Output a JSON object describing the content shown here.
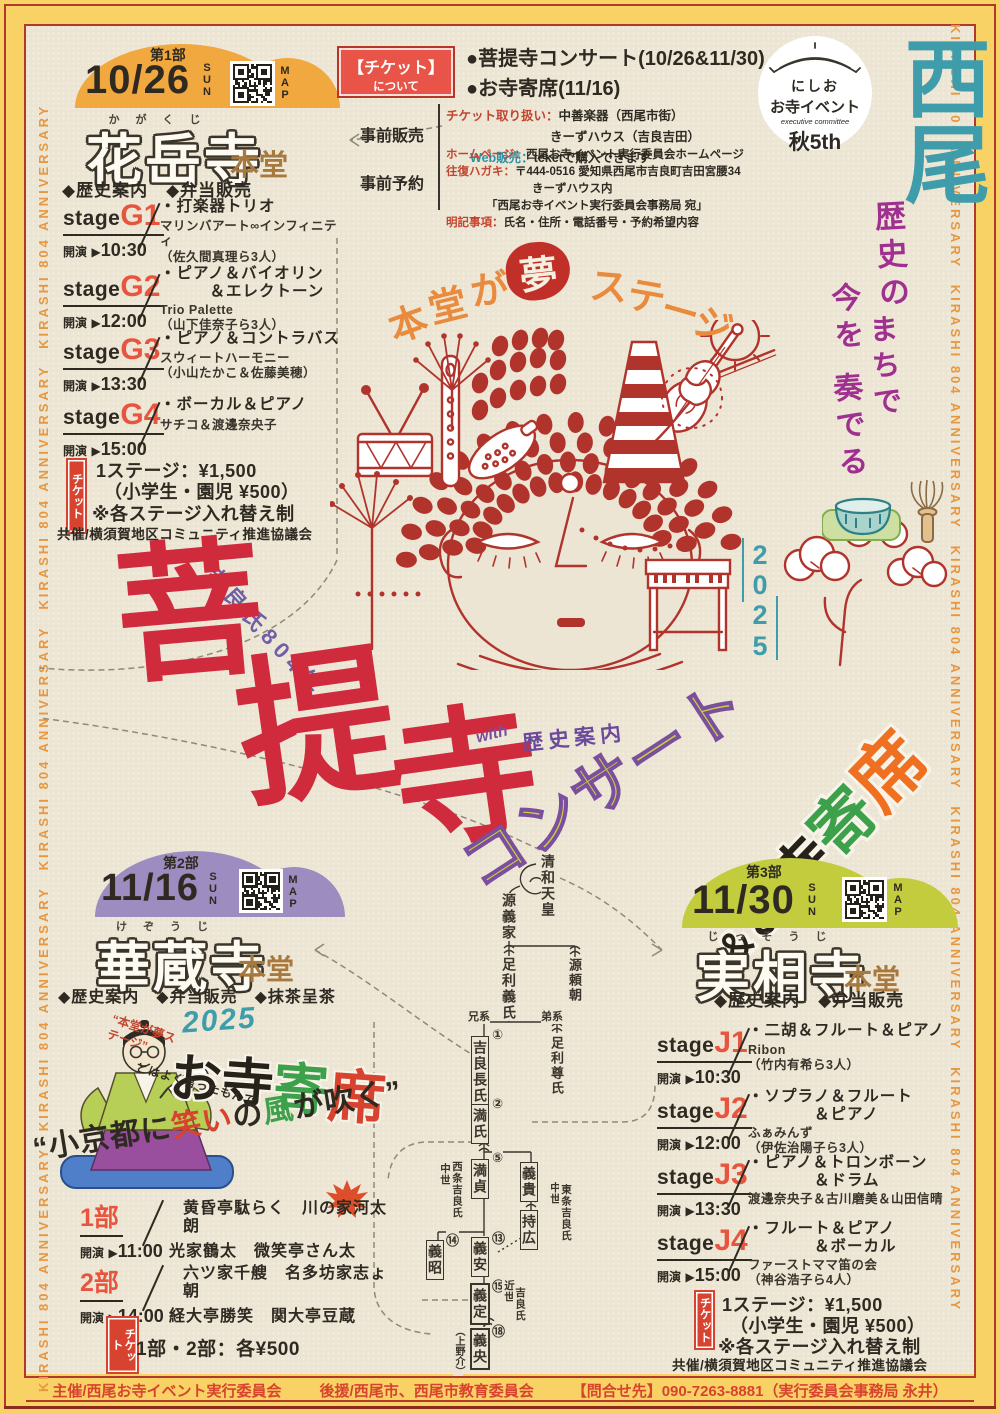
{
  "palette": {
    "bg_cream": "#ece5d3",
    "frame_yellow": "#f8d264",
    "frame_red": "#b0392b",
    "dome1_orange": "#f0a83f",
    "dome2_purple": "#9d8cc0",
    "dome3_yellowgreen": "#c3cc3d",
    "accent_red": "#d8432f",
    "art_red": "#b0342c",
    "teal": "#3f9dab",
    "purple": "#a0308f",
    "title_red": "#cf2b3c",
    "concert_green": "#c5d23e",
    "green": "#3da04b",
    "orange": "#ef7020",
    "brown": "#a8793f",
    "text_dark": "#2e2a22"
  },
  "frame": {
    "side_text": "KIRASHI 804 ANNIVERSARY　KIRASHI 804 ANNIVERSARY　KIRASHI 804 ANNIVERSARY　KIRASHI 804 ANNIVERSARY　KIRASHI 804 ANNIVERSARY"
  },
  "stages_common": {
    "stage": "stage",
    "kaien": "開演",
    "arrow": "▶"
  },
  "ticket_box": {
    "badge_title": "【チケット】",
    "badge_sub": "について",
    "item1": "●菩提寺コンサート(10/26&11/30)",
    "item2": "●お寺寄席(11/16)",
    "presale_label": "事前販売",
    "presale_l1_label": "チケット取り扱い：",
    "presale_l1": "中善楽器（西尾市街）",
    "presale_l2": "きーずハウス（吉良吉田）",
    "presale_l3_label": "Web販売：",
    "presale_l3": "teketで購入できます",
    "reserve_label": "事前予約",
    "reserve_l1_label": "ホームページ：",
    "reserve_l1": "西尾お寺イベント実行委員会ホームページ",
    "reserve_l2_label": "往復ハガキ：",
    "reserve_l2": "〒444-0516 愛知県西尾市吉良町吉田宮腰34",
    "reserve_l3": "きーずハウス内",
    "reserve_l4": "「西尾お寺イベント実行委員会事務局 宛」",
    "reserve_l5_label": "明記事項：",
    "reserve_l5": "氏名・住所・電話番号・予約希望内容"
  },
  "logo": {
    "line1": "にしお",
    "line2": "お寺イベント",
    "line3": "executive committee",
    "line4": "秋5th"
  },
  "nishio": {
    "chars": "西尾"
  },
  "tagline": {
    "c1": "歴史の",
    "c2": "まちで",
    "c3": "今を",
    "c4": "奏でる"
  },
  "dream": {
    "c0": "本",
    "c1": "堂",
    "c2": "が",
    "c3": "夢",
    "c4": "ス",
    "c5": "テ",
    "c6": "ー",
    "c7": "ジ"
  },
  "title": {
    "year": "吉良氏804年",
    "k1": "菩",
    "k2": "提",
    "k3": "寺",
    "with": "with",
    "guide": "歴史案内",
    "concert": "コンサート",
    "y0": "2",
    "y1": "0",
    "y2": "2",
    "y3": "5",
    "amp": "＆",
    "a1": "お",
    "a2": "寺",
    "a3": "寄",
    "a4": "席"
  },
  "part1": {
    "part": "第1部",
    "date": "10/26",
    "day": "SUN",
    "map": "MAP",
    "furigana": "かがくじ",
    "temple": "花岳寺",
    "hall": "本堂",
    "features": "◆歴史案内　◆弁当販売",
    "stages": [
      {
        "no": "G1",
        "time": "10:30",
        "p1": "・打楽器トリオ",
        "p2": "",
        "g1": "マリンバアート∞インフィニティ",
        "g2": "（佐久間真理ら3人）"
      },
      {
        "no": "G2",
        "time": "12:00",
        "p1": "・ピアノ＆バイオリン",
        "p2": "　　　＆エレクトーン",
        "g1": "Trio Palette",
        "g2": "（山下佳奈子ら3人）"
      },
      {
        "no": "G3",
        "time": "13:30",
        "p1": "・ピアノ＆コントラバス",
        "p2": "",
        "g1": "スウィートハーモニー",
        "g2": "（小山たかこ＆佐藤美穂）"
      },
      {
        "no": "G4",
        "time": "15:00",
        "p1": "・ボーカル＆ピアノ",
        "p2": "",
        "g1": "サチコ＆渡邊奈央子",
        "g2": ""
      }
    ],
    "ticket_badge": "チケット",
    "ticket1": "1ステージ：¥1,500",
    "ticket2": "（小学生・園児 ¥500）",
    "ticket3": "※各ステージ入れ替え制",
    "cosponsor": "共催/横須賀地区コミュニティ推進協議会"
  },
  "part2": {
    "part": "第2部",
    "date": "11/16",
    "day": "SUN",
    "map": "MAP",
    "furigana": "けぞうじ",
    "temple": "華蔵寺",
    "hall": "本堂",
    "features": "◆歴史案内　◆弁当販売　◆抹茶呈茶",
    "quote": "“本堂が夢ステージ”",
    "year": "2025",
    "yose1": "お寺",
    "yose2": "寄",
    "yose3": "席",
    "sub": "とはよく言ったもんで",
    "catch_a": "“小京都に",
    "catch_b": "笑い",
    "catch_c": "の",
    "catch_d": "風",
    "catch_e": "が吹く”",
    "programs": [
      {
        "no": "1部",
        "time": "11:00",
        "l1": "黄昏亭駄らく　川の家河太朗",
        "l2": "光家鶴太　微笑亭さん太"
      },
      {
        "no": "2部",
        "time": "14:00",
        "l1": "六ツ家千艘　名多坊家志ょ朝",
        "l2": "経大亭勝笑　関大亭豆蔵"
      }
    ],
    "ticket_badge": "チケット",
    "ticket": "1部・2部：各¥500"
  },
  "part3": {
    "part": "第3部",
    "date": "11/30",
    "day": "SUN",
    "map": "MAP",
    "furigana": "じっそうじ",
    "temple": "実相寺",
    "hall": "本堂",
    "features": "◆歴史案内　◆弁当販売",
    "stages": [
      {
        "no": "J1",
        "time": "10:30",
        "p1": "・二胡＆フルート＆ピアノ",
        "p2": "",
        "g1": "Ribon",
        "g2": "（竹内有希ら3人）"
      },
      {
        "no": "J2",
        "time": "12:00",
        "p1": "・ソプラノ＆フルート",
        "p2": "　　　　＆ピアノ",
        "g1": "ふぁみんず",
        "g2": "（伊佐治陽子ら3人）"
      },
      {
        "no": "J3",
        "time": "13:30",
        "p1": "・ピアノ＆トロンボーン",
        "p2": "　　　　＆ドラム",
        "g1": "渡邊奈央子＆古川磨美＆山田信晴",
        "g2": ""
      },
      {
        "no": "J4",
        "time": "15:00",
        "p1": "・フルート＆ピアノ",
        "p2": "　　　　＆ボーカル",
        "g1": "ファーストママ笛の会",
        "g2": "（神谷浩子ら4人）"
      }
    ],
    "ticket_badge": "チケット",
    "ticket1": "1ステージ：¥1,500",
    "ticket2": "（小学生・園児 ¥500）",
    "ticket3": "※各ステージ入れ替え制",
    "cosponsor": "共催/横須賀地区コミュニティ推進協議会"
  },
  "tree": {
    "seiwa": "清和天皇",
    "yoshiie": "源義家",
    "yoshiuji": "足利義氏",
    "yoritomo": "源頼朝",
    "kei_elder": "兄系",
    "kei_younger": "弟系",
    "n1": "①",
    "osauji": "吉良長氏",
    "takauji": "足利尊氏",
    "n2": "②",
    "mitsuuji": "満氏",
    "n5": "⑤",
    "mitsusada": "満貞",
    "yoshitaka": "義貴",
    "mochihiro": "持広",
    "n13": "⑬",
    "yoshiyasu": "義安",
    "n14": "⑭",
    "yoshiaki": "義昭",
    "n15": "⑮",
    "yoshisada": "義定",
    "n18": "⑱",
    "yoshihisa": "義央",
    "kozukenosuke": "（上野介）",
    "label_chusei_w": "中世",
    "label_saijo": "西条吉良氏",
    "label_chusei_e": "中世",
    "label_tojo": "東条吉良氏",
    "label_kinsei": "近世",
    "label_kira": "吉良氏"
  },
  "footer": {
    "organizer": "主催/西尾お寺イベント実行委員会",
    "support": "後援/西尾市、西尾市教育委員会",
    "contact": "【問合せ先】090-7263-8881（実行委員会事務局 永井）"
  }
}
